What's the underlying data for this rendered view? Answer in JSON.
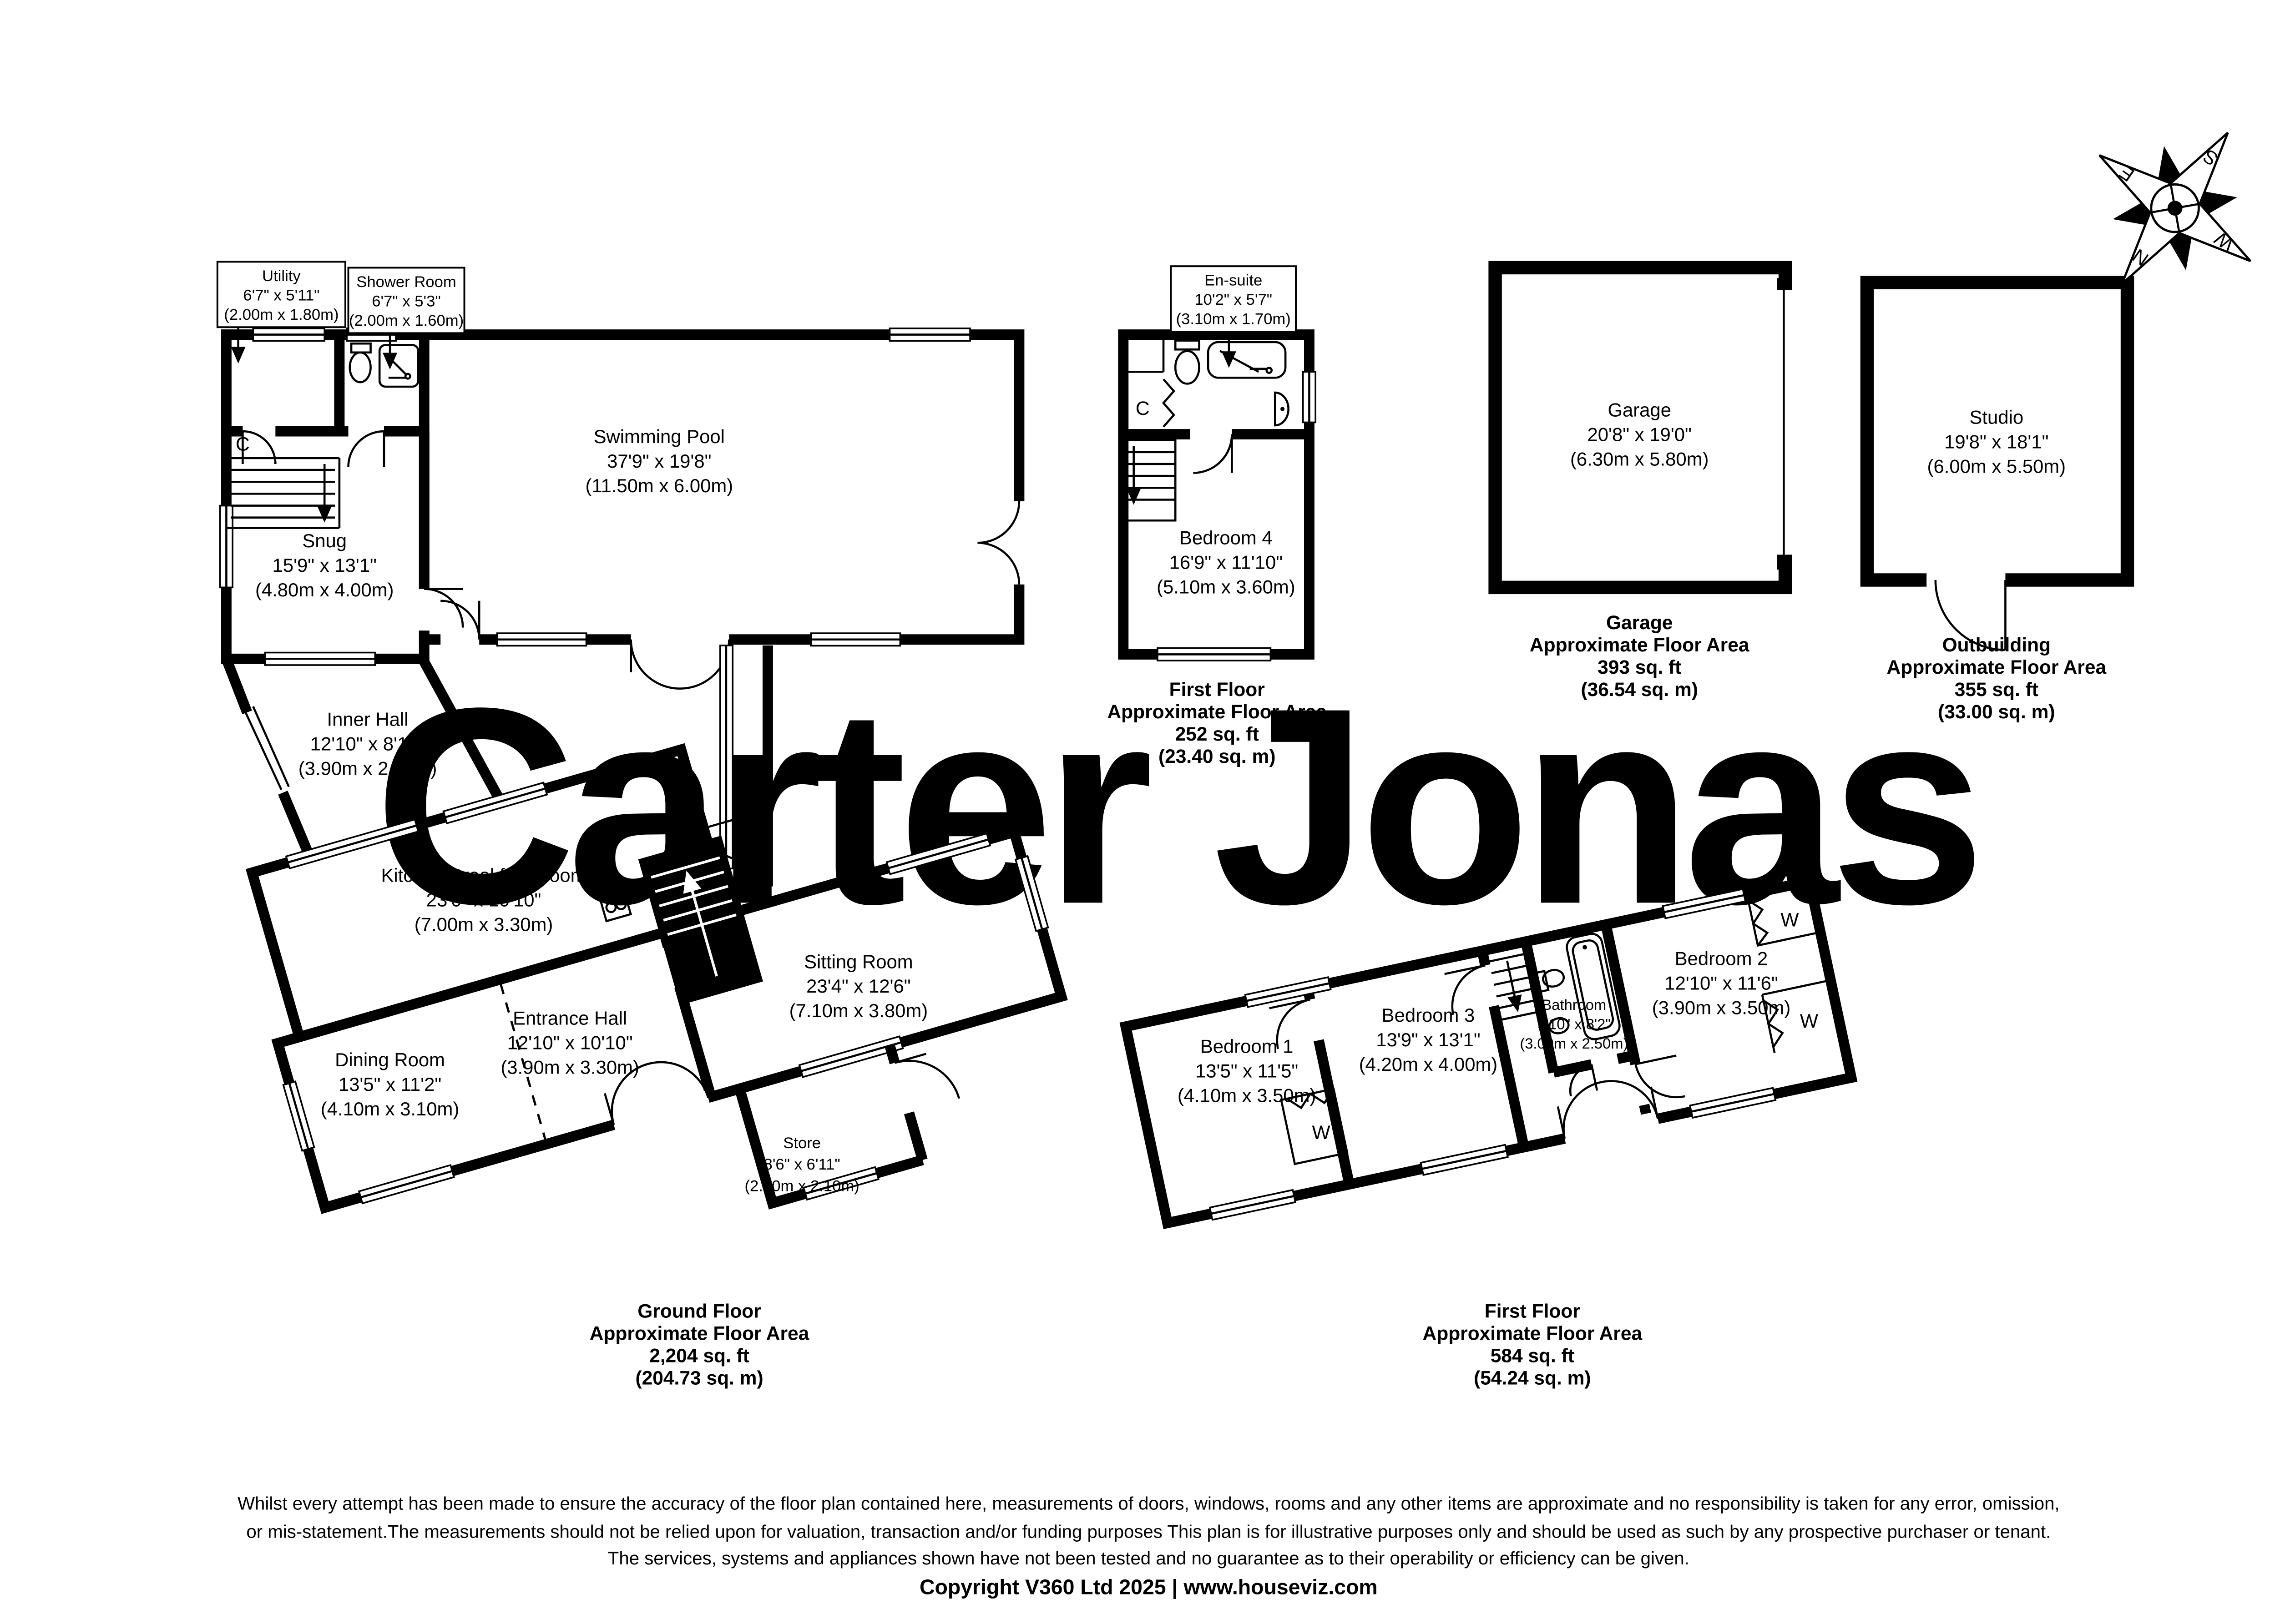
{
  "watermark": "Carter Jonas",
  "colors": {
    "wall": "#000000",
    "watermark": "#c9c9d2",
    "background": "#ffffff"
  },
  "compass": {
    "n": "N",
    "e": "E",
    "s": "S",
    "w": "W"
  },
  "closet_letter": "C",
  "wardrobe_letter": "W",
  "ground_floor": {
    "rooms": {
      "utility": {
        "name": "Utility",
        "imperial": "6'7\" x 5'11\"",
        "metric": "(2.00m x 1.80m)"
      },
      "shower_room": {
        "name": "Shower Room",
        "imperial": "6'7\" x 5'3\"",
        "metric": "(2.00m x 1.60m)"
      },
      "swimming_pool": {
        "name": "Swimming Pool",
        "imperial": "37'9\" x 19'8\"",
        "metric": "(11.50m x 6.00m)"
      },
      "snug": {
        "name": "Snug",
        "imperial": "15'9\" x 13'1\"",
        "metric": "(4.80m x 4.00m)"
      },
      "inner_hall": {
        "name": "Inner Hall",
        "imperial": "12'10\" x 8'10\"",
        "metric": "(3.90m x 2.70m)"
      },
      "kitchen": {
        "name": "Kitchen/Breakfast Room",
        "imperial": "23'0\" x 10'10\"",
        "metric": "(7.00m x 3.30m)"
      },
      "sitting_room": {
        "name": "Sitting Room",
        "imperial": "23'4\" x 12'6\"",
        "metric": "(7.10m x 3.80m)"
      },
      "entrance_hall": {
        "name": "Entrance Hall",
        "imperial": "12'10\" x 10'10\"",
        "metric": "(3.90m x 3.30m)"
      },
      "dining_room": {
        "name": "Dining Room",
        "imperial": "13'5\" x 11'2\"",
        "metric": "(4.10m x 3.10m)"
      },
      "store": {
        "name": "Store",
        "imperial": "8'6\" x 6'11\"",
        "metric": "(2.60m x 2.10m)"
      }
    },
    "summary": {
      "title": "Ground Floor",
      "subtitle": "Approximate Floor Area",
      "area_ft": "2,204 sq. ft",
      "area_m": "(204.73 sq. m)"
    }
  },
  "first_floor_annex": {
    "rooms": {
      "en_suite": {
        "name": "En-suite",
        "imperial": "10'2\" x 5'7\"",
        "metric": "(3.10m x 1.70m)"
      },
      "bedroom4": {
        "name": "Bedroom 4",
        "imperial": "16'9\" x 11'10\"",
        "metric": "(5.10m x 3.60m)"
      }
    },
    "summary": {
      "title": "First Floor",
      "subtitle": "Approximate Floor Area",
      "area_ft": "252 sq. ft",
      "area_m": "(23.40 sq. m)"
    }
  },
  "first_floor": {
    "rooms": {
      "bedroom1": {
        "name": "Bedroom 1",
        "imperial": "13'5\" x 11'5\"",
        "metric": "(4.10m x 3.50m)"
      },
      "bedroom3": {
        "name": "Bedroom 3",
        "imperial": "13'9\" x 13'1\"",
        "metric": "(4.20m x 4.00m)"
      },
      "bathroom": {
        "name": "Bathroom",
        "imperial": "9'10\" x 8'2\"",
        "metric": "(3.00m x 2.50m)"
      },
      "bedroom2": {
        "name": "Bedroom 2",
        "imperial": "12'10\" x 11'6\"",
        "metric": "(3.90m x 3.50m)"
      }
    },
    "summary": {
      "title": "First Floor",
      "subtitle": "Approximate Floor Area",
      "area_ft": "584 sq. ft",
      "area_m": "(54.24 sq. m)"
    }
  },
  "garage": {
    "room": {
      "name": "Garage",
      "imperial": "20'8\" x 19'0\"",
      "metric": "(6.30m x 5.80m)"
    },
    "summary": {
      "title": "Garage",
      "subtitle": "Approximate Floor Area",
      "area_ft": "393 sq. ft",
      "area_m": "(36.54 sq. m)"
    }
  },
  "outbuilding": {
    "room": {
      "name": "Studio",
      "imperial": "19'8\" x 18'1\"",
      "metric": "(6.00m x 5.50m)"
    },
    "summary": {
      "title": "Outbuilding",
      "subtitle": "Approximate Floor Area",
      "area_ft": "355 sq. ft",
      "area_m": "(33.00 sq. m)"
    }
  },
  "footer": {
    "line1": "Whilst every attempt has been made to ensure the accuracy of the floor plan contained here, measurements of doors, windows, rooms and any other items are approximate and no responsibility is taken for any error, omission,",
    "line2": "or mis-statement.The measurements should not be relied upon for valuation, transaction and/or funding purposes This plan is for illustrative purposes only and should be used as such by any prospective purchaser or tenant.",
    "line3": "The services, systems and appliances shown have not been tested and no guarantee as to their operability or efficiency can be given.",
    "copyright": "Copyright V360 Ltd 2025 | www.houseviz.com"
  }
}
